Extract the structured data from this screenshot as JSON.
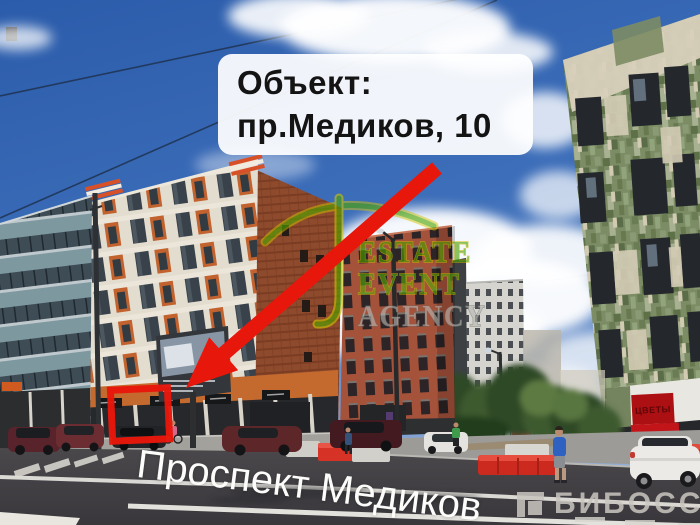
{
  "scene": {
    "street_label": "Проспект Медиков",
    "flower_shop_sign": "ЦВЕТЫ"
  },
  "callout": {
    "line1": "Объект:",
    "line2": "пр.Медиков, 10"
  },
  "watermark": {
    "line1": "ESTATE",
    "line2": "EVENT",
    "line3": "AGENCY"
  },
  "branding": {
    "logo_text": "БИБОСС"
  },
  "colors": {
    "annotation_red": "#e8170b",
    "callout_background": "#ffffff",
    "callout_text": "#141414",
    "watermark_green": "#4fa600",
    "watermark_yellow": "#d2c400",
    "watermark_silver": "#b9b9b3",
    "street_label_white": "#fcfcfa",
    "logo_gray": "#c9c5bf",
    "sky_blue": "#2d5fae",
    "brick_terracotta": "#8e4a2c",
    "orange_facade": "#a5523a",
    "green_mosaic": "#7c8c64",
    "flower_sign_red": "#ad1013"
  }
}
